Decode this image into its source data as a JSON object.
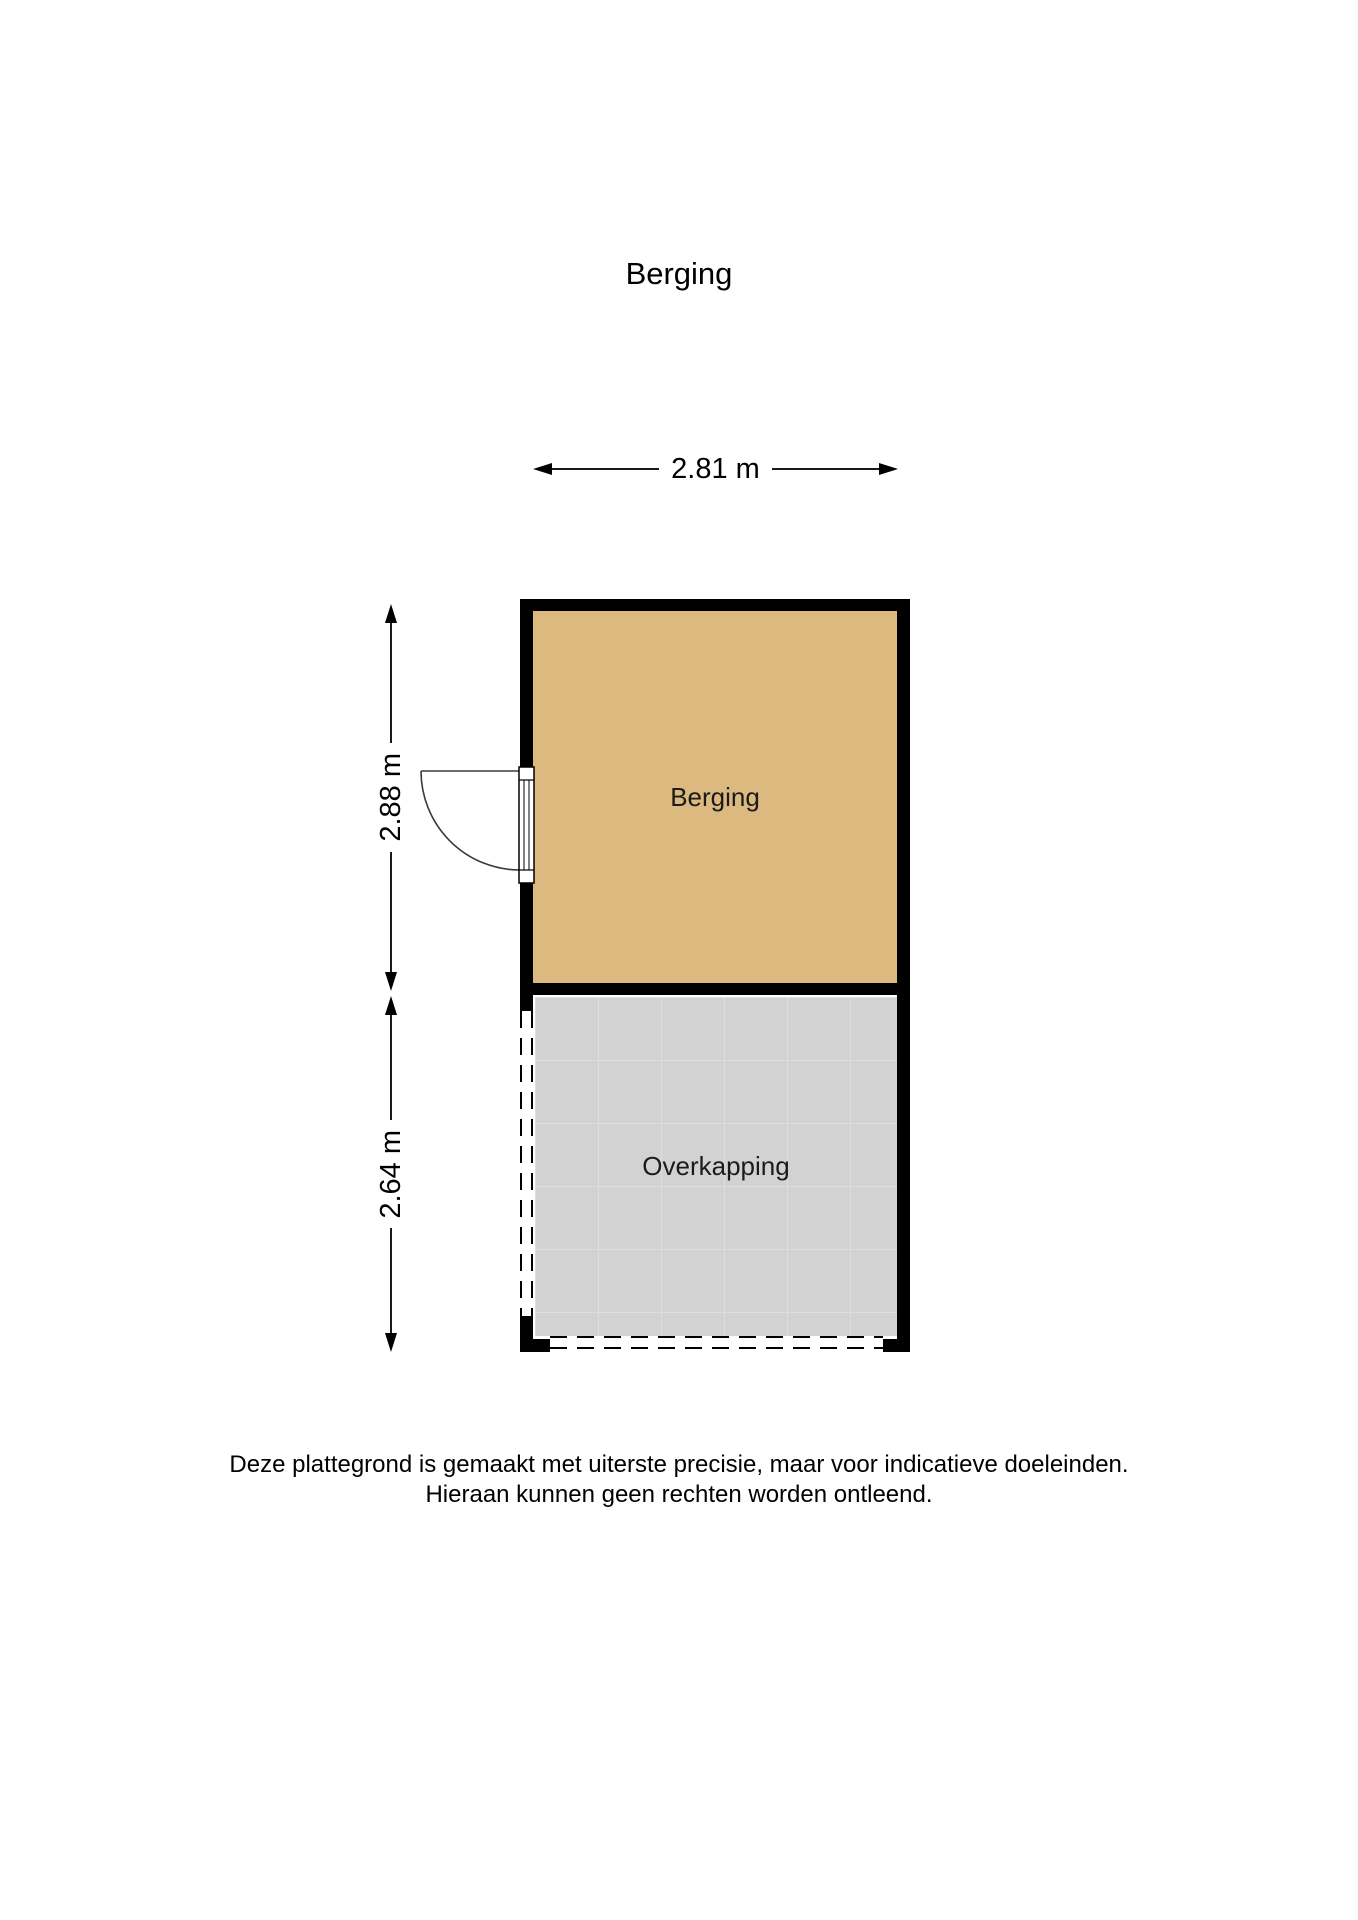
{
  "page_title": "Berging",
  "floor_plan": {
    "wall_color": "#000000",
    "rooms": [
      {
        "name": "berging",
        "label": "Berging",
        "floor_color": "#dcb97e"
      },
      {
        "name": "overkapping",
        "label": "Overkapping",
        "floor_color": "#d2d2d2",
        "grid_color": "#dedede",
        "boundary_style": "dashed-open"
      }
    ],
    "dimensions": {
      "width": {
        "label": "2.81 m",
        "orientation": "horizontal"
      },
      "berging_height": {
        "label": "2.88 m",
        "orientation": "vertical"
      },
      "overkapping_height": {
        "label": "2.64 m",
        "orientation": "vertical"
      }
    },
    "door": {
      "wall": "left",
      "room": "berging",
      "swing": "outward"
    }
  },
  "footer": {
    "line1": "Deze plattegrond is gemaakt met uiterste precisie, maar voor indicatieve doeleinden.",
    "line2": "Hieraan kunnen geen rechten worden ontleend."
  }
}
